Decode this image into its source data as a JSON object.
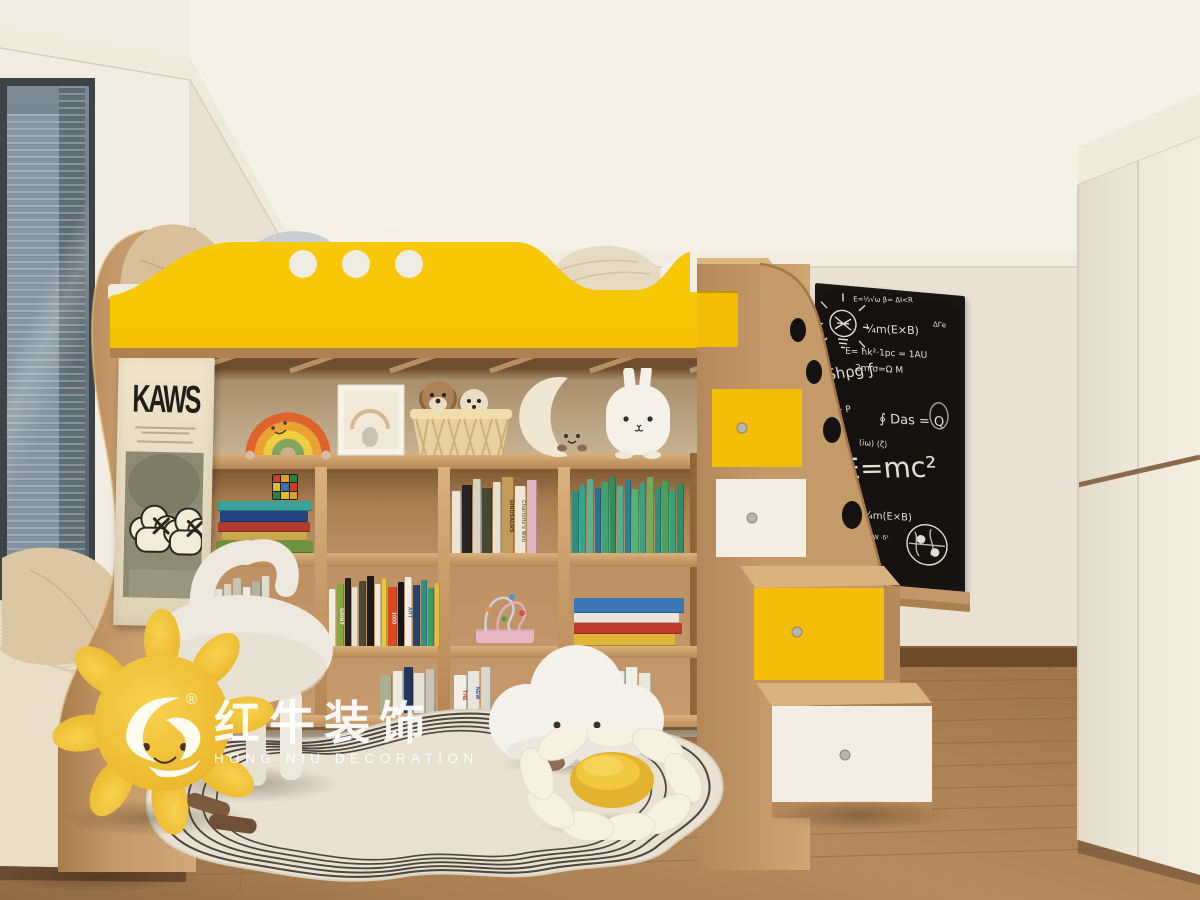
{
  "watermark": {
    "cn": "红牛装饰",
    "en": "HONG NIU DECORATION",
    "reg": "®"
  },
  "poster": {
    "brand": "KAWS"
  },
  "blackboard": {
    "doodles": [
      "lightbulb-sketch",
      "globe-sketch"
    ],
    "formulas": [
      {
        "t": "E=½√ω  β= ΔI<R",
        "x": 38,
        "y": 10,
        "s": 7,
        "r": -4
      },
      {
        "t": "ΔΓe",
        "x": 118,
        "y": 28,
        "s": 7,
        "r": 0
      },
      {
        "t": "¼m(E×B)",
        "x": 50,
        "y": 36,
        "s": 11,
        "r": -3
      },
      {
        "t": "E= ħk²·1pc = 1AU",
        "x": 30,
        "y": 62,
        "s": 9,
        "r": -2
      },
      {
        "t": "2m      σ=Ω M",
        "x": 40,
        "y": 78,
        "s": 9,
        "r": -2
      },
      {
        "t": "Shρg ƒ",
        "x": 10,
        "y": 84,
        "s": 15,
        "r": -12
      },
      {
        "t": "δP ~ P",
        "x": 6,
        "y": 124,
        "s": 9,
        "r": -8
      },
      {
        "t": "∮ Das = Q",
        "x": 64,
        "y": 124,
        "s": 13,
        "r": -2
      },
      {
        "t": "(iω)  (ζ)",
        "x": 44,
        "y": 152,
        "s": 8,
        "r": 0
      },
      {
        "t": "E=mc²",
        "x": 26,
        "y": 170,
        "s": 28,
        "r": -6
      },
      {
        "t": "¼m(E×B)",
        "x": 48,
        "y": 224,
        "s": 10,
        "r": -2
      },
      {
        "t": "ζ= ∫ e-w dW ·δ²",
        "x": 26,
        "y": 248,
        "s": 6,
        "r": -2
      },
      {
        "t": "ƒ(x)= Σ a·ε",
        "x": 26,
        "y": 259,
        "s": 6,
        "r": -2
      },
      {
        "t": "Jvωδ·a ≈ C",
        "x": 24,
        "y": 286,
        "s": 6,
        "r": -2
      }
    ]
  },
  "shelf": {
    "row1_stack": [
      [
        "#39a29a",
        10,
        "95"
      ],
      [
        "#23457f",
        11,
        "88"
      ],
      [
        "#b03a2c",
        10,
        "92"
      ],
      [
        "#c9a94c",
        9,
        "85"
      ],
      [
        "#6f923c",
        12,
        "97"
      ]
    ],
    "cube_colors": [
      "#c8401f",
      "#e0a020",
      "#2c7f3f",
      "#d9c02a",
      "#3a6fb0",
      "#c8401f",
      "#2c7f3f",
      "#d9c02a",
      "#e0a020"
    ],
    "row1_c3": [
      [
        "#ece5d3",
        9
      ],
      [
        "#26251f",
        10
      ],
      [
        "#d8d2c0",
        8
      ],
      [
        "#474738",
        10
      ],
      [
        "#e7e0ce",
        8
      ],
      [
        "#c59a58",
        12,
        "DINOSAURS",
        "#3c2a12"
      ],
      [
        "#efe7d5",
        11,
        "Charlotte's Web",
        "#7a6a4a"
      ],
      [
        "#e2b6c0",
        10
      ]
    ],
    "row1_c4": [
      [
        "#2e8f7f",
        7
      ],
      [
        "#36a38f",
        6
      ],
      [
        "#5bb08d",
        7
      ],
      [
        "#2b6f9c",
        6
      ],
      [
        "#43a06f",
        7
      ],
      [
        "#2f8f5c",
        6
      ],
      [
        "#52ae8f",
        7
      ],
      [
        "#2b7f9c",
        6
      ],
      [
        "#5bb06f",
        7
      ],
      [
        "#3d9e85",
        6
      ],
      [
        "#6fae57",
        7
      ],
      [
        "#2f8f7c",
        6
      ],
      [
        "#4f9e5f",
        7
      ],
      [
        "#38a07a",
        6
      ],
      [
        "#2b8f6f",
        7
      ]
    ],
    "row2_c1": [
      [
        "#e9e4d6",
        9
      ],
      [
        "#d8d2c2",
        8
      ],
      [
        "#c9c3b2",
        9
      ],
      [
        "#efeadd",
        8
      ],
      [
        "#b8b2a0",
        9
      ],
      [
        "#e2dccc",
        8
      ]
    ],
    "row2_c2": [
      [
        "#f0ece0",
        8
      ],
      [
        "#7fae3f",
        9,
        "GRINT",
        "#f2f2e8"
      ],
      [
        "#23221e",
        8
      ],
      [
        "#e8e2d2",
        7
      ],
      [
        "#4a4a3a",
        8
      ],
      [
        "#1d1c18",
        9
      ],
      [
        "#efe9da",
        8
      ],
      [
        "#e9c83a",
        6
      ],
      [
        "#d84b20",
        10,
        "1000",
        "#ffffff"
      ],
      [
        "#16161a",
        8
      ],
      [
        "#f1ede2",
        9,
        "ART",
        "#2a5fa8"
      ],
      [
        "#23456f",
        8
      ],
      [
        "#2f8f8a",
        7
      ],
      [
        "#3f9e5f",
        8
      ],
      [
        "#e0c23a",
        6
      ]
    ],
    "row2_stack4": [
      [
        "#3a78b5",
        15,
        "98"
      ],
      [
        "#e9e5da",
        10,
        "94"
      ],
      [
        "#bf3a2c",
        11,
        "96"
      ],
      [
        "#e0b53a",
        12,
        "90"
      ]
    ],
    "row3_c1": [
      [
        "#e9e4d6",
        10
      ],
      [
        "#d5cfbf",
        9
      ],
      [
        "#c2bcab",
        10
      ],
      [
        "#eae5d8",
        9
      ],
      [
        "#b2ac9a",
        10
      ]
    ],
    "row3_c2": [
      [
        "#a8b091",
        12
      ],
      [
        "#eceadf",
        10
      ],
      [
        "#24365c",
        9
      ],
      [
        "#e5e1d4",
        11
      ],
      [
        "#c9c4b4",
        9
      ]
    ],
    "row3_c2b": [
      [
        "#f2efe6",
        13,
        "THE",
        "#c22a1f"
      ],
      [
        "#e8e5da",
        12,
        "NEW",
        "#2a4fa0"
      ],
      [
        "#d9d5c8",
        10
      ]
    ],
    "row3_c3": [
      [
        "#f0ede4",
        12,
        "",
        "",
        "binder"
      ],
      [
        "#ece9de",
        12,
        "",
        "",
        "binder"
      ],
      [
        "#f2efe6",
        12,
        "",
        "",
        "binder"
      ],
      [
        "#e9e6da",
        12,
        "",
        "",
        "binder"
      ]
    ]
  },
  "objects": [
    "loft-bed-yellow-guardrail",
    "storage-staircase",
    "bookshelf",
    "kaws-fabric-poster",
    "chalkboard",
    "rainbow-plush",
    "photo-frame",
    "woven-basket-with-puppies",
    "moon-plush",
    "bunny-plush",
    "bead-maze-toy",
    "rubiks-cube",
    "pony-stool",
    "sun-plush",
    "cloud-plush",
    "daisy-pillow",
    "wavy-line-rug",
    "window-seat",
    "city-view-window",
    "built-in-wardrobe"
  ],
  "palette": {
    "wall": "#e9e2d3",
    "ceiling": "#f5f1e7",
    "wood": "#c79c6b",
    "wood_dark": "#9d7245",
    "accent_yellow": "#f7c600",
    "blackboard": "#14110f",
    "floor": "#a97e52",
    "rug": "#e9e2d3",
    "wardrobe": "#efe9dc",
    "window_glass": "#66747d",
    "white_drawer": "#f2eee4"
  }
}
